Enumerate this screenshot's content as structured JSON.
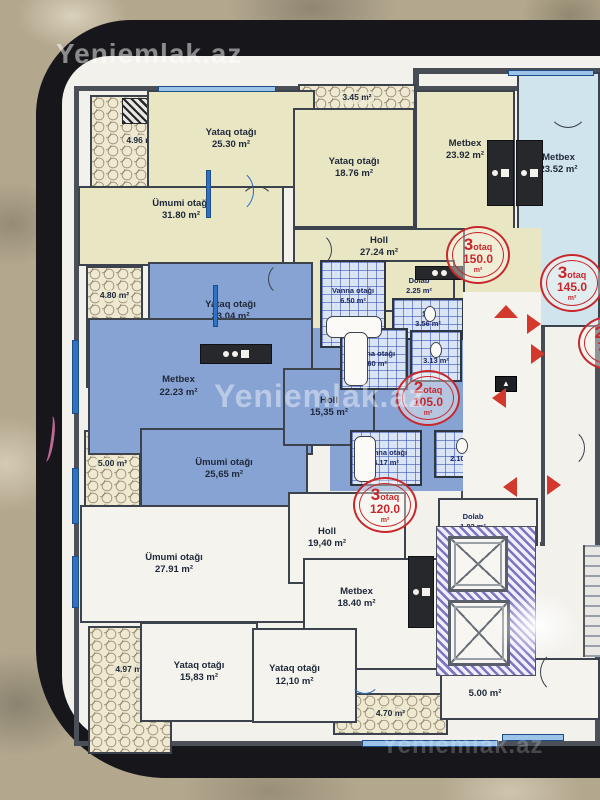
{
  "watermark": {
    "text": "Yeniemlak.az"
  },
  "colors": {
    "badge_red": "#c8272c",
    "room_cream": "#e9e6c3",
    "room_blue": "#87a3d4",
    "room_lightblue": "#cfe4ec",
    "window_blue": "#2f72c4"
  },
  "rooms": [
    {
      "name": "Yataq otağı",
      "area": "25.30 m²"
    },
    {
      "name": "Ümumi otağı",
      "area": "31.80 m²"
    },
    {
      "name": "Yataq otağı",
      "area": "18.76 m²"
    },
    {
      "name": "Metbex",
      "area": "23.92 m²"
    },
    {
      "name": "Metbex",
      "area": "23.52 m²"
    },
    {
      "name": "Holl",
      "area": "27.24 m²"
    },
    {
      "name": "Dolab",
      "area": "2.25 m²"
    },
    {
      "name": "Vanna otağı",
      "area": "6.50 m²"
    },
    {
      "name": "S/q",
      "area": "3.56 m²"
    },
    {
      "name": "Yataq otağı",
      "area": "23.04 m²"
    },
    {
      "name": "Metbex",
      "area": "22.23 m²"
    },
    {
      "name": "Vanna otağı",
      "area": "5.60 m²"
    },
    {
      "name": "S/q",
      "area": "3.13 m²"
    },
    {
      "name": "Holl",
      "area": "15,35 m²"
    },
    {
      "name": "Vanna otağı",
      "area": "4.17 m²"
    },
    {
      "name": "S/q",
      "area": "2.10 m²"
    },
    {
      "name": "Ümumi otağı",
      "area": "25,65 m²"
    },
    {
      "name": "Ümumi otağı",
      "area": "27.91 m²"
    },
    {
      "name": "Holl",
      "area": "19,40 m²"
    },
    {
      "name": "Metbex",
      "area": "18.40 m²"
    },
    {
      "name": "Dolab",
      "area": "1.82 m²"
    },
    {
      "name": "Yataq otağı",
      "area": "15,83 m²"
    },
    {
      "name": "Yataq otağı",
      "area": "12,10 m²"
    },
    {
      "name": "",
      "area": "5.00 m²"
    }
  ],
  "balconies": [
    "4.96 m²",
    "3.45 m²",
    "4.80 m²",
    "5.00 m²",
    "4.97 m²",
    "4.70 m²"
  ],
  "badges": [
    {
      "count": "3",
      "word": "otaq",
      "area": "150.0",
      "unit": "m²"
    },
    {
      "count": "3",
      "word": "otaq",
      "area": "145.0",
      "unit": "m²"
    },
    {
      "count": "2",
      "word": "otaq",
      "area": "105.0",
      "unit": "m²"
    },
    {
      "count": "3",
      "word": "otaq",
      "area": "120.0",
      "unit": "m²"
    },
    {
      "count": "2",
      "word": "otaq",
      "area": "70.0",
      "unit": "m²"
    }
  ]
}
